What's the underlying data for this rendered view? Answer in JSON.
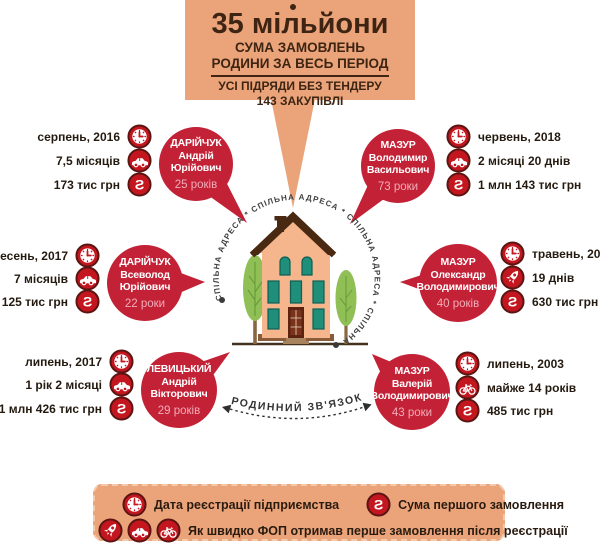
{
  "header": {
    "title": "35 мільйони",
    "subtitle_line1": "СУМА ЗАМОВЛЕНЬ",
    "subtitle_line2": "РОДИНИ ЗА ВЕСЬ ПЕРІОД",
    "note_line1": "УСІ ПІДРЯДИ БЕЗ ТЕНДЕРУ",
    "note_line2": "143 ЗАКУПІВЛІ"
  },
  "center": {
    "address_text": "СПІЛЬНА АДРЕСА * СПІЛЬНА АДРЕСА * СПІЛЬНА АДРЕСА * СПІЛЬНА АДРЕСА * СПІЛЬНА АДРЕСА *",
    "family_link_text": "РОДИННИЙ ЗВ'ЯЗОК"
  },
  "people": [
    {
      "surname": "ДАРІЙЧУК",
      "name_line1": "Андрій",
      "name_line2": "Юрійович",
      "age": "25 років",
      "registration_date": "серпень, 2016",
      "speed": "7,5 місяців",
      "speed_icon": "car-icon",
      "first_order_sum": "173 тис грн"
    },
    {
      "surname": "ДАРІЙЧУК",
      "name_line1": "Всеволод",
      "name_line2": "Юрійович",
      "age": "22 роки",
      "registration_date": "вересень, 2017",
      "speed": "7 місяців",
      "speed_icon": "car-icon",
      "first_order_sum": "125 тис грн"
    },
    {
      "surname": "ЛЕВИЦЬКИЙ",
      "name_line1": "Андрій",
      "name_line2": "Вікторович",
      "age": "29 років",
      "registration_date": "липень, 2017",
      "speed": "1 рік 2 місяці",
      "speed_icon": "car-icon",
      "first_order_sum": "1 млн 426 тис грн"
    },
    {
      "surname": "МАЗУР",
      "name_line1": "Володимир",
      "name_line2": "Васильович",
      "age": "73 роки",
      "registration_date": "червень, 2018",
      "speed": "2 місяці 20 днів",
      "speed_icon": "car-icon",
      "first_order_sum": "1 млн 143 тис грн"
    },
    {
      "surname": "МАЗУР",
      "name_line1": "Олександр",
      "name_line2": "Володимирович",
      "age": "40 років",
      "registration_date": "травень, 2018",
      "speed": "19 днів",
      "speed_icon": "rocket-icon",
      "first_order_sum": "630 тис грн"
    },
    {
      "surname": "МАЗУР",
      "name_line1": "Валерій",
      "name_line2": "Володимирович",
      "age": "43 роки",
      "registration_date": "липень, 2003",
      "speed": "майже 14 років",
      "speed_icon": "bicycle-icon",
      "first_order_sum": "485 тис грн"
    }
  ],
  "legend": {
    "item_registration": {
      "icon": "clock-icon",
      "label": "Дата реєстрації підприємства"
    },
    "item_sum": {
      "icon": "money-icon",
      "label": "Сума першого замовлення"
    },
    "item_speed": {
      "icons": [
        "rocket-icon",
        "car-icon",
        "bicycle-icon"
      ],
      "label": "Як швидко ФОП отримав перше замовлення після реєстрації"
    }
  },
  "icons": {
    "clock-icon": "clock on red circle",
    "car-icon": "car on red circle",
    "rocket-icon": "rocket on red circle",
    "bicycle-icon": "bicycle on red circle",
    "money-icon": "mirrored S money symbol on red circle"
  },
  "colors": {
    "salmon": "#EBA47A",
    "bubble_red": "#C32136",
    "icon_red": "#C3161F",
    "icon_ring": "#5A1512",
    "title_brown": "#3E2413",
    "house_facade": "#F5B58D",
    "roof_brown": "#4A2913",
    "window_teal": "#1F8E7B",
    "tree_green": "#8FBF55"
  }
}
